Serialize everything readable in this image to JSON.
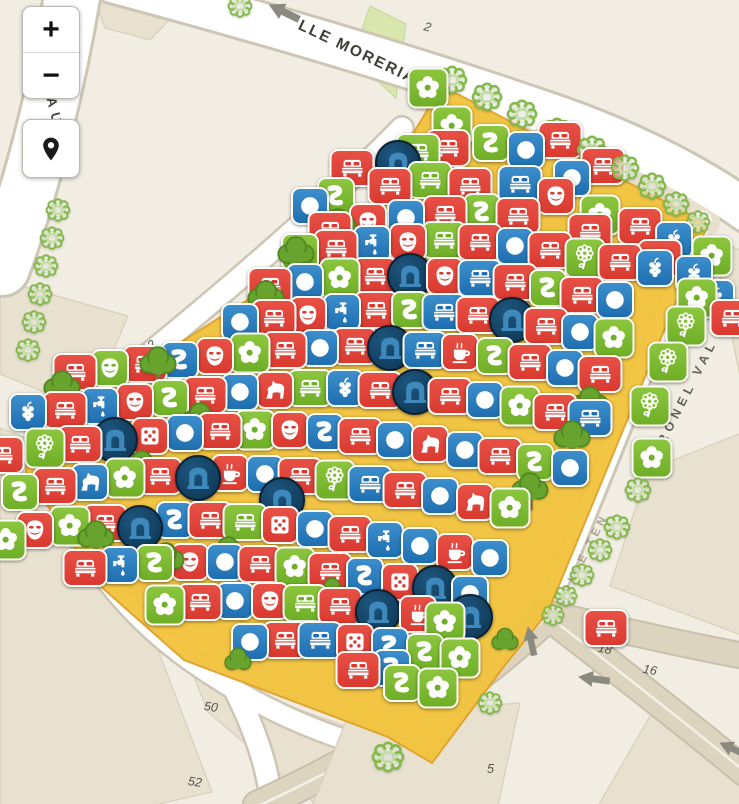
{
  "app": {
    "title": "Map viewer"
  },
  "controls": {
    "zoom_in_label": "+",
    "zoom_out_label": "−",
    "locate_icon": "location-pin-icon"
  },
  "colors": {
    "red": "#d93a30",
    "green": "#6fae27",
    "green_light": "#8cc63e",
    "blue": "#1f6fb0",
    "navy": "#0e3450",
    "highlight": "#f2c33d",
    "highlight_border": "#dfa22c",
    "street_white": "#ffffff",
    "street_casing": "#cdc6b4",
    "street_tan": "#ddd4bf",
    "building": "#e8e1cf",
    "background": "#f1ede2"
  },
  "street_labels": [
    {
      "text": "LLE MORERIA",
      "x": 299,
      "y": 16,
      "rot": 25.5,
      "size": 15.5,
      "ls": 2,
      "color": "#3e3d38",
      "opacity": 1
    },
    {
      "text": "CESAR AUGU",
      "x": 30,
      "y": 6,
      "rot": 76,
      "size": 13.5,
      "ls": 6,
      "color": "#454440",
      "opacity": 1
    },
    {
      "text": "CORONEL VAL",
      "x": 648,
      "y": 462,
      "rot": -63,
      "size": 12.5,
      "ls": 5,
      "color": "#4a4a42",
      "opacity": 0.85
    },
    {
      "text": "CALLE TEN",
      "x": 560,
      "y": 598,
      "rot": -63,
      "size": 11.5,
      "ls": 4,
      "color": "#6a6250",
      "opacity": 0.5
    }
  ],
  "street_numbers": [
    {
      "text": "2",
      "x": 424,
      "y": 20,
      "rot": 15
    },
    {
      "text": "14",
      "x": 312,
      "y": 188,
      "rot": -38
    },
    {
      "text": "12",
      "x": 142,
      "y": 340,
      "rot": -38
    },
    {
      "text": "50",
      "x": 204,
      "y": 700,
      "rot": 8
    },
    {
      "text": "52",
      "x": 188,
      "y": 775,
      "rot": 8
    },
    {
      "text": "18",
      "x": 598,
      "y": 642,
      "rot": 10
    },
    {
      "text": "16",
      "x": 643,
      "y": 663,
      "rot": 10
    },
    {
      "text": "5",
      "x": 487,
      "y": 762,
      "rot": 0
    }
  ],
  "oneway_arrows": [
    {
      "x": 284,
      "y": 12,
      "rot": 206,
      "w": 34
    },
    {
      "x": 531,
      "y": 641,
      "rot": -102,
      "w": 30
    },
    {
      "x": 594,
      "y": 679,
      "rot": 188,
      "w": 32
    },
    {
      "x": 733,
      "y": 749,
      "rot": 205,
      "w": 30
    }
  ],
  "marker_schema": [
    "x",
    "y",
    "color(r|g|b|n)",
    "icon"
  ],
  "icon_names": {
    "bed": "bed-icon",
    "cir": "circle-icon",
    "flo": "flower-icon",
    "dai": "daisy-icon",
    "snk": "squiggle-icon",
    "msk": "theater-mask-icon",
    "arc": "monument-arch-icon",
    "cof": "coffee-icon",
    "hor": "horse-icon",
    "fau": "tap-icon",
    "dic": "dice-icon",
    "grp": "grapes-icon"
  },
  "markers": [
    [
      428,
      88,
      "g",
      "flo"
    ],
    [
      452,
      126,
      "g",
      "flo"
    ],
    [
      418,
      152,
      "g",
      "bed"
    ],
    [
      398,
      163,
      "n",
      "arc"
    ],
    [
      526,
      150,
      "b",
      "cir"
    ],
    [
      572,
      178,
      "b",
      "cir"
    ],
    [
      603,
      166,
      "r",
      "bed"
    ],
    [
      560,
      140,
      "r",
      "bed"
    ],
    [
      491,
      143,
      "g",
      "snk"
    ],
    [
      448,
      148,
      "r",
      "bed"
    ],
    [
      352,
      168,
      "r",
      "bed"
    ],
    [
      390,
      186,
      "r",
      "bed"
    ],
    [
      430,
      180,
      "g",
      "bed"
    ],
    [
      470,
      186,
      "r",
      "bed"
    ],
    [
      520,
      184,
      "b",
      "bed"
    ],
    [
      556,
      196,
      "r",
      "msk"
    ],
    [
      310,
      206,
      "b",
      "cir"
    ],
    [
      336,
      196,
      "g",
      "snk"
    ],
    [
      600,
      215,
      "g",
      "flo"
    ],
    [
      640,
      226,
      "r",
      "bed"
    ],
    [
      674,
      240,
      "b",
      "grp"
    ],
    [
      330,
      230,
      "r",
      "bed"
    ],
    [
      368,
      222,
      "r",
      "msk"
    ],
    [
      406,
      218,
      "b",
      "cir"
    ],
    [
      445,
      214,
      "r",
      "bed"
    ],
    [
      482,
      212,
      "g",
      "snk"
    ],
    [
      518,
      216,
      "r",
      "bed"
    ],
    [
      590,
      232,
      "r",
      "bed"
    ],
    [
      660,
      258,
      "r",
      "bed"
    ],
    [
      712,
      256,
      "g",
      "flo"
    ],
    [
      694,
      274,
      "b",
      "grp"
    ],
    [
      716,
      298,
      "b",
      "grp"
    ],
    [
      300,
      252,
      "g",
      "snk"
    ],
    [
      336,
      248,
      "r",
      "bed"
    ],
    [
      372,
      244,
      "b",
      "fau"
    ],
    [
      408,
      242,
      "r",
      "msk"
    ],
    [
      444,
      240,
      "g",
      "bed"
    ],
    [
      480,
      242,
      "r",
      "bed"
    ],
    [
      515,
      246,
      "b",
      "cir"
    ],
    [
      550,
      250,
      "r",
      "bed"
    ],
    [
      585,
      258,
      "g",
      "dai"
    ],
    [
      620,
      262,
      "r",
      "bed"
    ],
    [
      655,
      268,
      "b",
      "grp"
    ],
    [
      697,
      298,
      "g",
      "flo"
    ],
    [
      270,
      286,
      "r",
      "bed"
    ],
    [
      305,
      282,
      "b",
      "cir"
    ],
    [
      340,
      278,
      "g",
      "flo"
    ],
    [
      375,
      276,
      "r",
      "bed"
    ],
    [
      410,
      276,
      "n",
      "arc"
    ],
    [
      445,
      276,
      "r",
      "msk"
    ],
    [
      480,
      278,
      "b",
      "bed"
    ],
    [
      515,
      282,
      "r",
      "bed"
    ],
    [
      548,
      288,
      "g",
      "snk"
    ],
    [
      582,
      295,
      "r",
      "bed"
    ],
    [
      615,
      300,
      "b",
      "cir"
    ],
    [
      686,
      326,
      "g",
      "dai"
    ],
    [
      732,
      318,
      "r",
      "bed"
    ],
    [
      240,
      322,
      "b",
      "cir"
    ],
    [
      274,
      318,
      "r",
      "bed"
    ],
    [
      308,
      315,
      "r",
      "msk"
    ],
    [
      342,
      312,
      "b",
      "fau"
    ],
    [
      376,
      310,
      "r",
      "bed"
    ],
    [
      410,
      310,
      "g",
      "snk"
    ],
    [
      444,
      312,
      "b",
      "bed"
    ],
    [
      478,
      315,
      "r",
      "bed"
    ],
    [
      512,
      320,
      "n",
      "arc"
    ],
    [
      546,
      326,
      "r",
      "bed"
    ],
    [
      580,
      332,
      "b",
      "cir"
    ],
    [
      614,
      338,
      "g",
      "flo"
    ],
    [
      668,
      362,
      "g",
      "dai"
    ],
    [
      75,
      372,
      "r",
      "bed"
    ],
    [
      110,
      368,
      "g",
      "msk"
    ],
    [
      145,
      364,
      "r",
      "bed"
    ],
    [
      180,
      360,
      "b",
      "snk"
    ],
    [
      215,
      356,
      "r",
      "msk"
    ],
    [
      250,
      353,
      "g",
      "flo"
    ],
    [
      285,
      350,
      "r",
      "bed"
    ],
    [
      320,
      348,
      "b",
      "cir"
    ],
    [
      355,
      346,
      "r",
      "bed"
    ],
    [
      390,
      348,
      "n",
      "arc"
    ],
    [
      425,
      350,
      "b",
      "bed"
    ],
    [
      460,
      352,
      "r",
      "cof"
    ],
    [
      495,
      356,
      "g",
      "snk"
    ],
    [
      530,
      362,
      "r",
      "bed"
    ],
    [
      565,
      368,
      "b",
      "cir"
    ],
    [
      600,
      374,
      "r",
      "bed"
    ],
    [
      650,
      406,
      "g",
      "dai"
    ],
    [
      28,
      412,
      "b",
      "grp"
    ],
    [
      65,
      410,
      "r",
      "bed"
    ],
    [
      100,
      406,
      "b",
      "fau"
    ],
    [
      135,
      402,
      "r",
      "msk"
    ],
    [
      170,
      398,
      "g",
      "snk"
    ],
    [
      205,
      395,
      "r",
      "bed"
    ],
    [
      240,
      392,
      "b",
      "cir"
    ],
    [
      275,
      390,
      "r",
      "hor"
    ],
    [
      310,
      388,
      "g",
      "bed"
    ],
    [
      345,
      388,
      "b",
      "grp"
    ],
    [
      380,
      390,
      "r",
      "bed"
    ],
    [
      415,
      392,
      "n",
      "arc"
    ],
    [
      450,
      396,
      "r",
      "bed"
    ],
    [
      485,
      400,
      "b",
      "cir"
    ],
    [
      520,
      406,
      "g",
      "flo"
    ],
    [
      555,
      412,
      "r",
      "bed"
    ],
    [
      590,
      418,
      "b",
      "bed"
    ],
    [
      652,
      458,
      "g",
      "flo"
    ],
    [
      2,
      455,
      "r",
      "bed"
    ],
    [
      45,
      448,
      "g",
      "dai"
    ],
    [
      80,
      444,
      "r",
      "bed"
    ],
    [
      115,
      440,
      "n",
      "arc"
    ],
    [
      150,
      436,
      "r",
      "dic"
    ],
    [
      185,
      433,
      "b",
      "cir"
    ],
    [
      220,
      431,
      "r",
      "bed"
    ],
    [
      255,
      430,
      "g",
      "flo"
    ],
    [
      290,
      430,
      "r",
      "msk"
    ],
    [
      325,
      432,
      "b",
      "snk"
    ],
    [
      360,
      436,
      "r",
      "bed"
    ],
    [
      395,
      440,
      "b",
      "cir"
    ],
    [
      430,
      444,
      "r",
      "hor"
    ],
    [
      465,
      450,
      "b",
      "cir"
    ],
    [
      500,
      456,
      "r",
      "bed"
    ],
    [
      535,
      462,
      "g",
      "snk"
    ],
    [
      570,
      468,
      "b",
      "cir"
    ],
    [
      20,
      492,
      "g",
      "snk"
    ],
    [
      55,
      486,
      "r",
      "bed"
    ],
    [
      90,
      482,
      "b",
      "hor"
    ],
    [
      125,
      478,
      "g",
      "flo"
    ],
    [
      160,
      476,
      "r",
      "bed"
    ],
    [
      198,
      478,
      "n",
      "arc"
    ],
    [
      230,
      473,
      "r",
      "cof"
    ],
    [
      265,
      474,
      "b",
      "cir"
    ],
    [
      300,
      476,
      "r",
      "bed"
    ],
    [
      335,
      480,
      "g",
      "dai"
    ],
    [
      370,
      484,
      "b",
      "bed"
    ],
    [
      405,
      490,
      "r",
      "bed"
    ],
    [
      440,
      496,
      "b",
      "cir"
    ],
    [
      475,
      502,
      "r",
      "hor"
    ],
    [
      510,
      508,
      "g",
      "flo"
    ],
    [
      282,
      500,
      "n",
      "arc"
    ],
    [
      6,
      540,
      "g",
      "flo"
    ],
    [
      35,
      530,
      "r",
      "msk"
    ],
    [
      70,
      526,
      "g",
      "flo"
    ],
    [
      105,
      523,
      "r",
      "bed"
    ],
    [
      140,
      528,
      "n",
      "arc"
    ],
    [
      175,
      520,
      "b",
      "snk"
    ],
    [
      210,
      520,
      "r",
      "bed"
    ],
    [
      245,
      522,
      "g",
      "bed"
    ],
    [
      280,
      525,
      "r",
      "dic"
    ],
    [
      315,
      529,
      "b",
      "cir"
    ],
    [
      350,
      534,
      "r",
      "bed"
    ],
    [
      385,
      540,
      "b",
      "fau"
    ],
    [
      420,
      546,
      "b",
      "cir"
    ],
    [
      455,
      552,
      "r",
      "cof"
    ],
    [
      490,
      558,
      "b",
      "cir"
    ],
    [
      85,
      568,
      "r",
      "bed"
    ],
    [
      120,
      565,
      "b",
      "fau"
    ],
    [
      155,
      563,
      "g",
      "snk"
    ],
    [
      190,
      562,
      "r",
      "msk"
    ],
    [
      225,
      562,
      "b",
      "cir"
    ],
    [
      260,
      564,
      "r",
      "bed"
    ],
    [
      295,
      567,
      "g",
      "flo"
    ],
    [
      330,
      571,
      "r",
      "bed"
    ],
    [
      365,
      576,
      "b",
      "snk"
    ],
    [
      400,
      582,
      "r",
      "dic"
    ],
    [
      435,
      588,
      "n",
      "arc"
    ],
    [
      470,
      594,
      "b",
      "cir"
    ],
    [
      165,
      605,
      "g",
      "flo"
    ],
    [
      200,
      602,
      "r",
      "bed"
    ],
    [
      235,
      601,
      "b",
      "cir"
    ],
    [
      270,
      601,
      "r",
      "msk"
    ],
    [
      305,
      603,
      "g",
      "bed"
    ],
    [
      340,
      606,
      "r",
      "bed"
    ],
    [
      378,
      612,
      "n",
      "arc"
    ],
    [
      418,
      614,
      "r",
      "cof"
    ],
    [
      445,
      622,
      "g",
      "flo"
    ],
    [
      606,
      628,
      "r",
      "bed"
    ],
    [
      250,
      642,
      "b",
      "cir"
    ],
    [
      285,
      640,
      "r",
      "bed"
    ],
    [
      320,
      640,
      "b",
      "bed"
    ],
    [
      355,
      642,
      "r",
      "dic"
    ],
    [
      390,
      646,
      "b",
      "snk"
    ],
    [
      425,
      652,
      "g",
      "snk"
    ],
    [
      470,
      617,
      "n",
      "arc"
    ],
    [
      460,
      658,
      "g",
      "flo"
    ],
    [
      358,
      670,
      "r",
      "bed"
    ],
    [
      392,
      668,
      "b",
      "snk"
    ],
    [
      402,
      683,
      "g",
      "snk"
    ],
    [
      438,
      688,
      "g",
      "flo"
    ]
  ],
  "trees_solid": [
    [
      338,
      228
    ],
    [
      296,
      256
    ],
    [
      266,
      300
    ],
    [
      158,
      366
    ],
    [
      62,
      390
    ],
    [
      200,
      422
    ],
    [
      142,
      470
    ],
    [
      96,
      540
    ],
    [
      228,
      556
    ],
    [
      166,
      562
    ],
    [
      590,
      406
    ],
    [
      572,
      440
    ],
    [
      530,
      492
    ]
  ],
  "bushes_solid": [
    [
      332,
      588
    ],
    [
      238,
      658
    ],
    [
      505,
      638
    ]
  ],
  "bushes_outline": [
    [
      240,
      6,
      13
    ],
    [
      452,
      80,
      16
    ],
    [
      487,
      97,
      16
    ],
    [
      522,
      114,
      16
    ],
    [
      557,
      132,
      16
    ],
    [
      592,
      150,
      16
    ],
    [
      625,
      168,
      15
    ],
    [
      652,
      186,
      15
    ],
    [
      676,
      204,
      14
    ],
    [
      698,
      222,
      13
    ],
    [
      58,
      210,
      13
    ],
    [
      52,
      238,
      13
    ],
    [
      46,
      266,
      13
    ],
    [
      40,
      294,
      13
    ],
    [
      34,
      322,
      13
    ],
    [
      28,
      350,
      13
    ],
    [
      638,
      490,
      14
    ],
    [
      617,
      527,
      14
    ],
    [
      600,
      550,
      13
    ],
    [
      582,
      575,
      13
    ],
    [
      566,
      596,
      12
    ],
    [
      553,
      615,
      12
    ],
    [
      490,
      703,
      13
    ],
    [
      388,
      757,
      17
    ]
  ],
  "highlight_polygon": "442,86 708,224 548,612 505,665 432,763 388,737 184,660 98,584 26,472 32,398 118,382 352,234"
}
